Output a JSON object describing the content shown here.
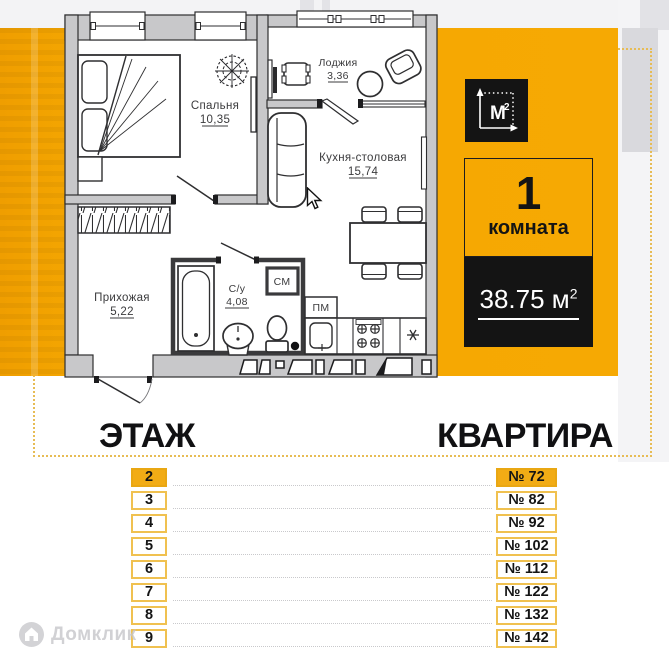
{
  "plan": {
    "rooms": [
      {
        "name": "Спальня",
        "area": "10,35"
      },
      {
        "name": "Лоджия",
        "area": "3,36"
      },
      {
        "name": "Кухня-столовая",
        "area": "15,74"
      },
      {
        "name": "Прихожая",
        "area": "5,22"
      },
      {
        "name": "С/у",
        "area": "4,08"
      }
    ],
    "labels": {
      "washing_machine": "СМ",
      "dishwasher": "ПМ"
    }
  },
  "summary": {
    "badge_letter": "М",
    "badge_sup": "2",
    "rooms_count": "1",
    "rooms_label": "комната",
    "area_value": "38.75 м",
    "area_sup": "2"
  },
  "table": {
    "floor_header": "ЭТАЖ",
    "apartment_header": "КВАРТИРА",
    "rows": [
      {
        "floor": "2",
        "apartment": "№ 72",
        "highlighted": true
      },
      {
        "floor": "3",
        "apartment": "№ 82",
        "highlighted": false
      },
      {
        "floor": "4",
        "apartment": "№ 92",
        "highlighted": false
      },
      {
        "floor": "5",
        "apartment": "№ 102",
        "highlighted": false
      },
      {
        "floor": "6",
        "apartment": "№ 112",
        "highlighted": false
      },
      {
        "floor": "7",
        "apartment": "№ 122",
        "highlighted": false
      },
      {
        "floor": "8",
        "apartment": "№ 132",
        "highlighted": false
      },
      {
        "floor": "9",
        "apartment": "№ 142",
        "highlighted": false
      }
    ]
  },
  "watermark": {
    "text": "Домклик"
  },
  "colors": {
    "accent_orange": "#F5A701",
    "row_highlight": "#F2AC15",
    "box_border": "#F0C150",
    "card_black": "#141414",
    "frame_dotted": "#E7BC55"
  }
}
